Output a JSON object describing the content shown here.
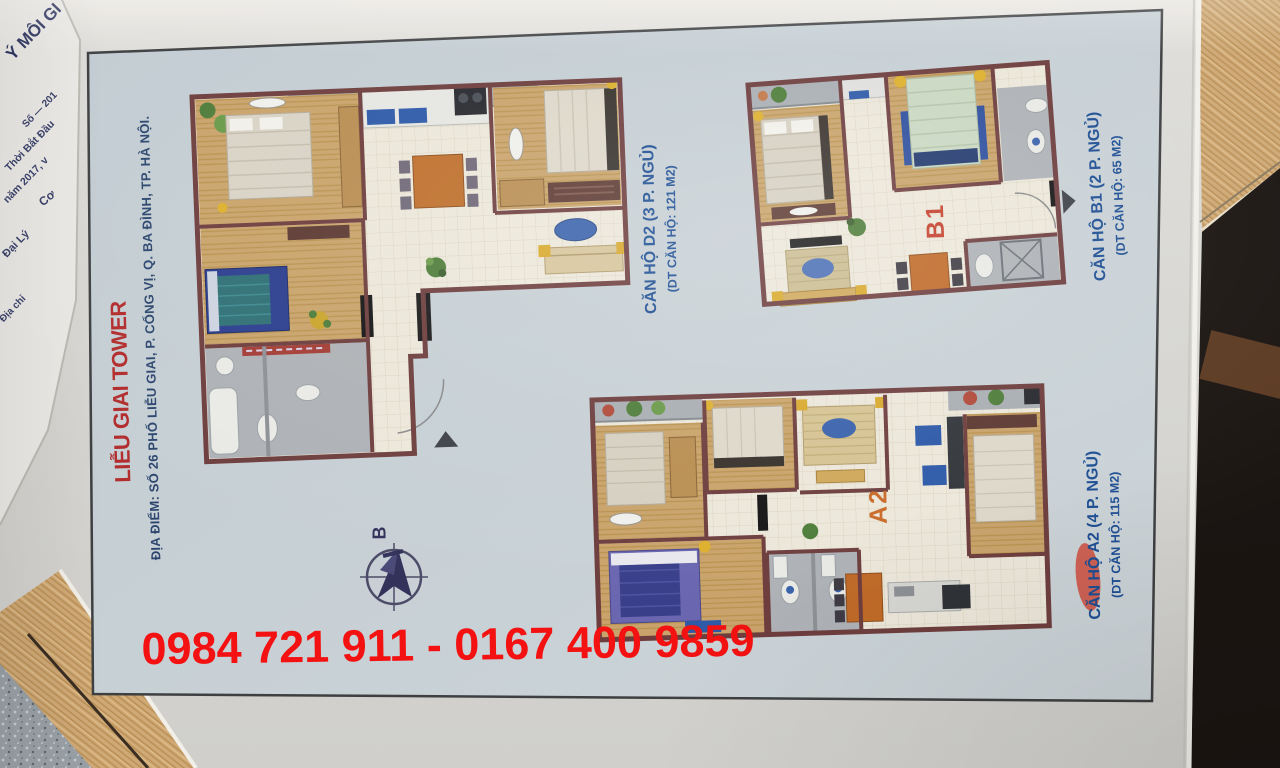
{
  "document": {
    "title": "LIỄU GIAI TOWER",
    "address": "ĐỊA ĐIỂM: SỐ 26 PHỐ LIỄU GIAI, P. CỐNG VỊ, Q. BA ĐÌNH, TP. HÀ NỘI.",
    "phone": "0984 721 911 - 0167 400 9859",
    "compass_label": "B"
  },
  "apartments": [
    {
      "code": "D2",
      "label": "CĂN HỘ D2 (3 P. NGỦ)",
      "area_label": "(DT CĂN HỘ: 121 M2)"
    },
    {
      "code": "B1",
      "label": "CĂN HỘ B1 (2 P. NGỦ)",
      "area_label": "(DT CĂN HỘ: 65 M2)"
    },
    {
      "code": "A2",
      "label": "CĂN HỘ A2 (4 P. NGỦ)",
      "area_label": "(DT CĂN HỘ: 115 M2)"
    }
  ],
  "underlying_paper": {
    "fragments": [
      "Ý MÔI GI",
      "Số — 201",
      "Thời Bắt Đầu",
      "năm 2017, v",
      "Cơ",
      "Đại Lý",
      "Địa chỉ"
    ]
  },
  "colors": {
    "title_red": "#b22c2c",
    "phone_red": "#f31111",
    "label_blue": "#1d4e93",
    "code_red": "#c5402c",
    "code_orange": "#c96b2a",
    "wall_maroon": "#6e3e3e"
  }
}
